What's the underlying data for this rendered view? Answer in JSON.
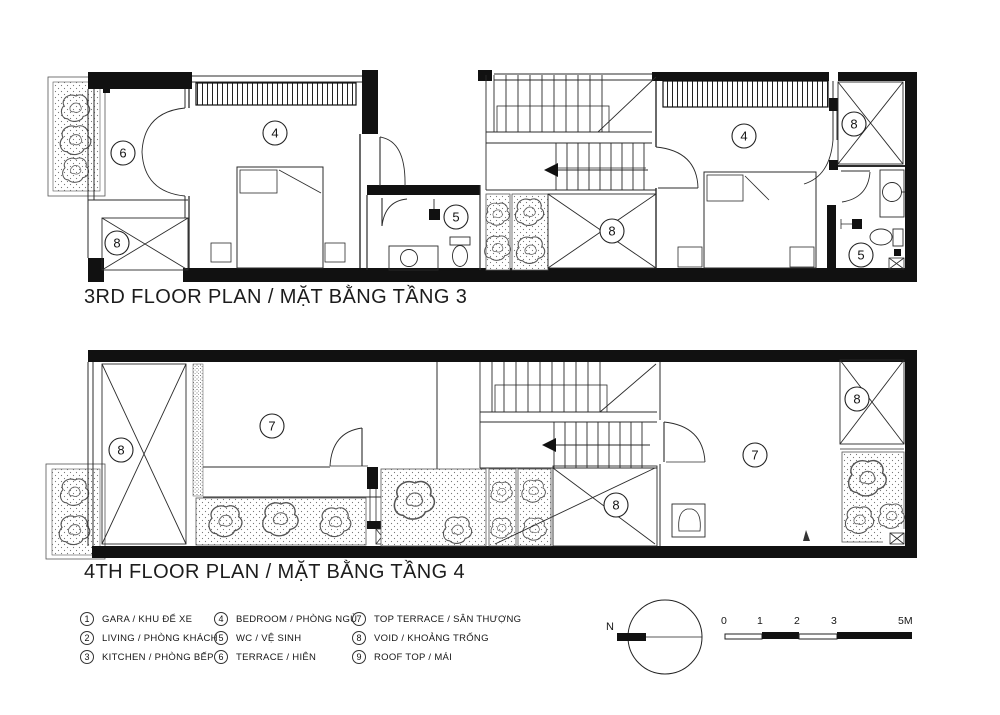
{
  "plans": [
    {
      "title": "3RD FLOOR PLAN / MẶT BẰNG TẦNG 3",
      "room_labels": [
        {
          "num": "6"
        },
        {
          "num": "8"
        },
        {
          "num": "4"
        },
        {
          "num": "5"
        },
        {
          "num": "8"
        },
        {
          "num": "4"
        },
        {
          "num": "8"
        },
        {
          "num": "5"
        }
      ]
    },
    {
      "title": "4TH FLOOR PLAN / MẶT BẰNG TẦNG 4",
      "room_labels": [
        {
          "num": "8"
        },
        {
          "num": "7"
        },
        {
          "num": "8"
        },
        {
          "num": "7"
        },
        {
          "num": "8"
        }
      ]
    }
  ],
  "legend": {
    "items": [
      {
        "num": "1",
        "label": "GARA / KHU ĐỂ XE"
      },
      {
        "num": "2",
        "label": "LIVING / PHÒNG KHÁCH"
      },
      {
        "num": "3",
        "label": "KITCHEN / PHÒNG BẾP"
      },
      {
        "num": "4",
        "label": "BEDROOM / PHÒNG NGỦ"
      },
      {
        "num": "5",
        "label": "WC / VỆ SINH"
      },
      {
        "num": "6",
        "label": "TERRACE / HIÊN"
      },
      {
        "num": "7",
        "label": "TOP TERRACE / SÂN THƯỢNG"
      },
      {
        "num": "8",
        "label": "VOID / KHOẢNG TRỐNG"
      },
      {
        "num": "9",
        "label": "ROOF TOP / MÁI"
      }
    ]
  },
  "compass": {
    "north_label": "N"
  },
  "scale_bar": {
    "ticks": [
      "0",
      "1",
      "2",
      "3",
      "5M"
    ]
  }
}
